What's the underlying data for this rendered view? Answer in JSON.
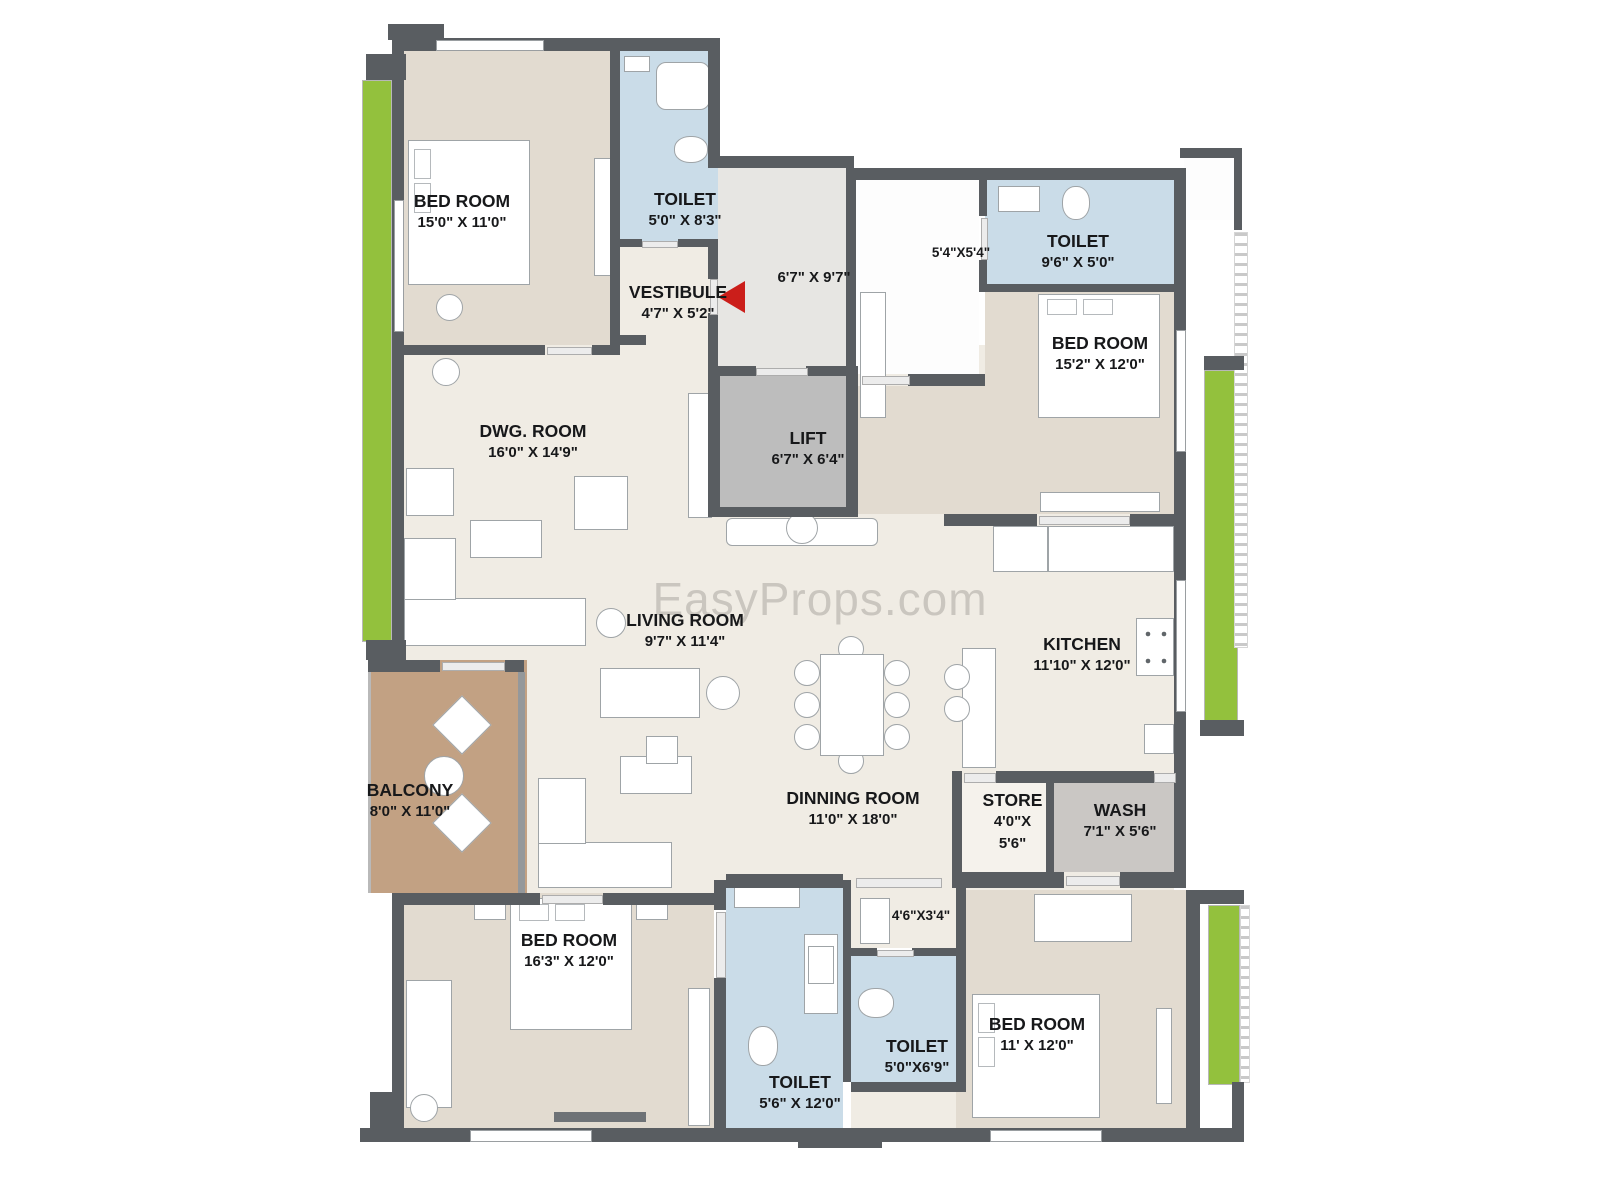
{
  "title": "Apartment Floor Plan",
  "watermark": "EasyProps.com",
  "colors": {
    "wall": "#595d61",
    "floor_cream": "#f0ece4",
    "floor_beige": "#e2dbd0",
    "toilet_blue": "#cadce8",
    "balcony_brown": "#c2a183",
    "lift_gray": "#bdbdbd",
    "planter_green": "#93c13d",
    "entry_arrow_red": "#cb1e1a"
  },
  "rooms": {
    "bedroom1": {
      "name": "BED ROOM",
      "dims": "15'0\" X 11'0\""
    },
    "toilet1": {
      "name": "TOILET",
      "dims": "5'0\" X 8'3\""
    },
    "vestibule": {
      "name": "VESTIBULE",
      "dims": "4'7\" X 5'2\""
    },
    "entry_foyer": {
      "dims": "6'7\" X 9'7\""
    },
    "passage_top": {
      "dims": "5'4\"X5'4\""
    },
    "toilet2": {
      "name": "TOILET",
      "dims": "9'6\" X 5'0\""
    },
    "bedroom2": {
      "name": "BED ROOM",
      "dims": "15'2\" X 12'0\""
    },
    "dwg_room": {
      "name": "DWG. ROOM",
      "dims": "16'0\" X 14'9\""
    },
    "lift": {
      "name": "LIFT",
      "dims": "6'7\" X 6'4\""
    },
    "living_room": {
      "name": "LIVING ROOM",
      "dims": "9'7\" X 11'4\""
    },
    "kitchen": {
      "name": "KITCHEN",
      "dims": "11'10\" X 12'0\""
    },
    "balcony": {
      "name": "BALCONY",
      "dims": "8'0\" X 11'0\""
    },
    "dining_room": {
      "name": "DINNING ROOM",
      "dims": "11'0\" X 18'0\""
    },
    "store": {
      "name": "STORE",
      "dims1": "4'0\"X",
      "dims2": "5'6\""
    },
    "wash": {
      "name": "WASH",
      "dims": "7'1\" X 5'6\""
    },
    "bedroom3": {
      "name": "BED ROOM",
      "dims": "16'3\" X 12'0\""
    },
    "toilet3": {
      "name": "TOILET",
      "dims": "5'6\" X 12'0\""
    },
    "toilet4": {
      "name": "TOILET",
      "dims": "5'0\"X6'9\""
    },
    "passage_bottom": {
      "dims": "4'6\"X3'4\""
    },
    "bedroom4": {
      "name": "BED ROOM",
      "dims": "11' X 12'0\""
    }
  }
}
